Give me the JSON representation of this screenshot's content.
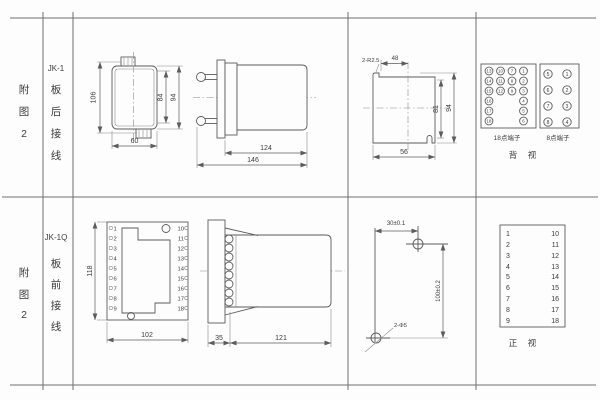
{
  "palette": {
    "line": "#5c5c5c",
    "text": "#3b3b3b",
    "background": "#fdfdfd"
  },
  "top_row": {
    "fig_chars": [
      "附",
      "图",
      "2"
    ],
    "model": "JK-1",
    "wiring_chars": [
      "板",
      "后",
      "接",
      "线"
    ],
    "front_view": {
      "dim_height_total": "106",
      "dim_height_84": "84",
      "dim_height_94": "94",
      "dim_width": "60"
    },
    "side_view": {
      "dim_depth_body": "124",
      "dim_depth_total": "146"
    },
    "cutout_view": {
      "corner_label": "2-R2.5",
      "dim_top": "48",
      "dim_inner_h": "81",
      "dim_outer_h": "94",
      "dim_bottom": "56"
    },
    "rear_terminals_18": {
      "caption": "18点端子",
      "col1": [
        "13",
        "14",
        "15",
        "16",
        "17",
        "18"
      ],
      "col2": [
        "10",
        "11",
        "12"
      ],
      "col3": [
        "7",
        "8",
        "9"
      ],
      "col4": [
        "1",
        "2",
        "3",
        "4",
        "5",
        "6"
      ]
    },
    "rear_terminals_8": {
      "caption": "8点端子",
      "col1": [
        "5",
        "6",
        "7",
        "8"
      ],
      "col2": [
        "1",
        "2",
        "3",
        "4"
      ]
    },
    "view_chars": [
      "背",
      "视"
    ]
  },
  "bottom_row": {
    "fig_chars": [
      "附",
      "图",
      "2"
    ],
    "model": "JK-1Q",
    "wiring_chars": [
      "板",
      "前",
      "接",
      "线"
    ],
    "front_view": {
      "dim_height": "118",
      "dim_width": "102",
      "left_terminals": [
        "1",
        "2",
        "3",
        "4",
        "5",
        "6",
        "7",
        "8",
        "9"
      ],
      "right_terminals": [
        "10",
        "11",
        "12",
        "13",
        "14",
        "15",
        "16",
        "17",
        "18"
      ]
    },
    "side_view": {
      "dim_plate": "35",
      "dim_depth": "121"
    },
    "drill_view": {
      "dim_horizontal": "30±0.1",
      "dim_vertical": "100±0.2",
      "hole_label": "2-Φ5"
    },
    "terminal_table": {
      "left": [
        "1",
        "2",
        "3",
        "4",
        "5",
        "6",
        "7",
        "8",
        "9"
      ],
      "right": [
        "10",
        "11",
        "12",
        "13",
        "14",
        "15",
        "16",
        "17",
        "18"
      ]
    },
    "view_chars": [
      "正",
      "视"
    ]
  }
}
